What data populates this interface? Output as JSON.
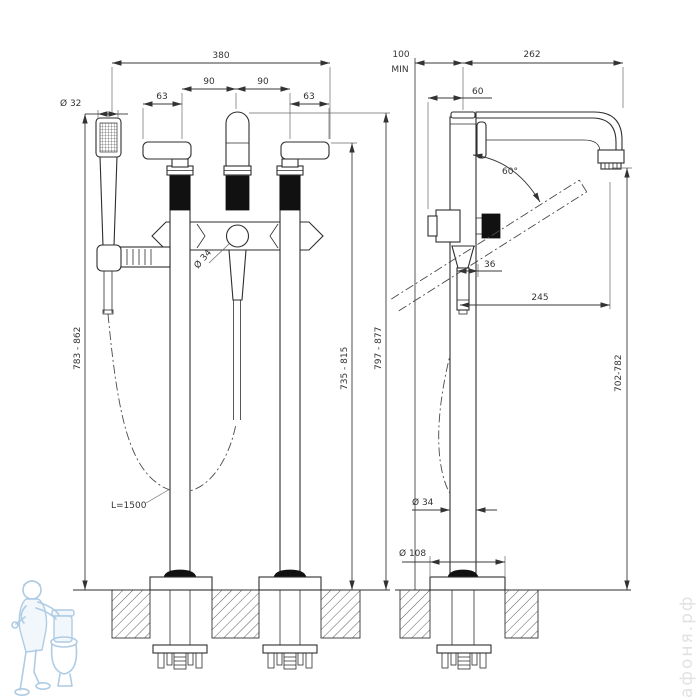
{
  "drawing": {
    "front_view": {
      "dim_total_width": "380",
      "dim_handle_spacing_left": "90",
      "dim_handle_spacing_right": "90",
      "dim_handle_offset_left": "63",
      "dim_handle_offset_right": "63",
      "dim_handshower_diameter": "Ø 32",
      "dim_spout_diameter": "Ø 34",
      "dim_height_handshower": "783 - 862",
      "dim_height_handle": "735 - 815",
      "dim_height_total": "797 - 877",
      "dim_hose_length": "L=1500"
    },
    "side_view": {
      "dim_wall_distance": "100",
      "dim_wall_distance_note": "MIN",
      "dim_spout_reach_total": "262",
      "dim_handle_offset": "60",
      "dim_swivel_angle": "60°",
      "dim_hose_offset": "36",
      "dim_spout_reach": "245",
      "dim_outlet_height": "702-782",
      "dim_column_diameter": "Ø 34",
      "dim_base_diameter": "Ø 108"
    },
    "watermark": {
      "site": "афоня.рф"
    }
  }
}
